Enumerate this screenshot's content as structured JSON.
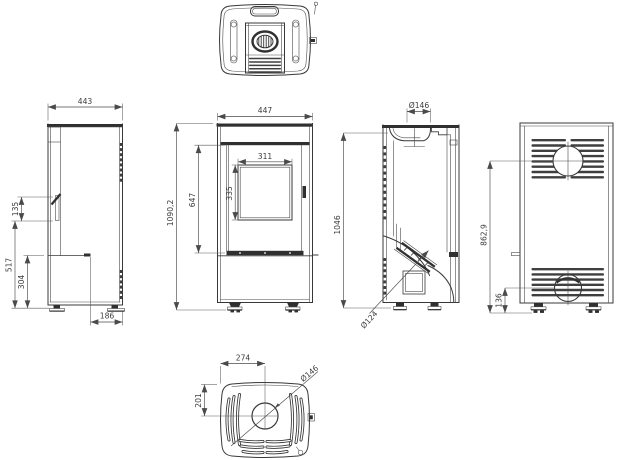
{
  "drawing": {
    "background": "#ffffff",
    "line_color": "#383838",
    "dim_color": "#4a4a4a",
    "views": {
      "left_side": {
        "width": "443",
        "handle_height": "135",
        "handle_bottom_height": "517",
        "base_height": "304",
        "rear_offset": "186"
      },
      "front": {
        "width": "447",
        "total_height": "1090,2",
        "door_height": "647",
        "glass_width": "311",
        "glass_height": "335"
      },
      "right_side": {
        "flue_collar_diameter": "Ø146",
        "body_height": "1046",
        "flue_pipe_diameter": "Ø124"
      },
      "rear": {
        "flue_center_height": "862,9",
        "bottom_vent_height": "136"
      },
      "bottom": {
        "flue_offset_x": "274",
        "flue_offset_y": "201",
        "flue_diameter": "Ø146"
      }
    }
  }
}
